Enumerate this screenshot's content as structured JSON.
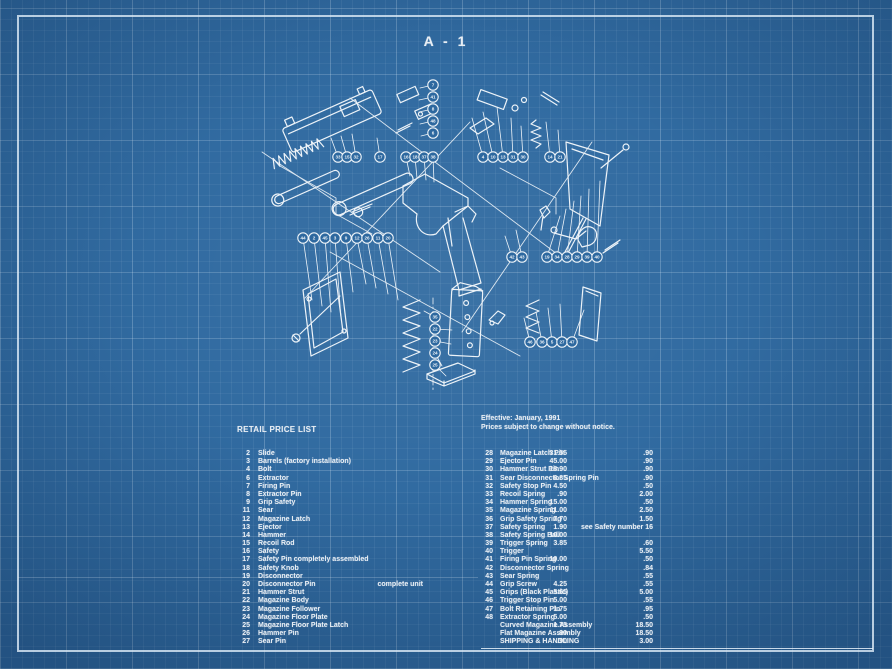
{
  "title": "A - 1",
  "left_list": {
    "header": "RETAIL PRICE LIST",
    "rows": [
      {
        "num": "2",
        "name": "Slide",
        "price": "31.55"
      },
      {
        "num": "3",
        "name": "Barrels (factory installation)",
        "price": "45.00"
      },
      {
        "num": "4",
        "name": "Bolt",
        "price": "18.90"
      },
      {
        "num": "6",
        "name": "Extractor",
        "price": "6.85"
      },
      {
        "num": "7",
        "name": "Firing Pin",
        "price": "4.50"
      },
      {
        "num": "8",
        "name": "Extractor Pin",
        "price": ".90"
      },
      {
        "num": "9",
        "name": "Grip Safety",
        "price": "15.00"
      },
      {
        "num": "11",
        "name": "Sear",
        "price": "11.00"
      },
      {
        "num": "12",
        "name": "Magazine Latch",
        "price": "7.70"
      },
      {
        "num": "13",
        "name": "Ejector",
        "price": "1.90"
      },
      {
        "num": "14",
        "name": "Hammer",
        "price": "10.00"
      },
      {
        "num": "15",
        "name": "Recoil Rod",
        "price": "3.85"
      },
      {
        "num": "16",
        "name": "Safety",
        "price": ""
      },
      {
        "num": "17",
        "name": "Safety Pin completely assembled",
        "price": "10.00"
      },
      {
        "num": "18",
        "name": "Safety Knob",
        "price": ""
      },
      {
        "num": "19",
        "name": "Disconnector",
        "price": ""
      },
      {
        "num": "20",
        "name": "Disconnector Pin",
        "note": "complete unit",
        "price": "4.25"
      },
      {
        "num": "21",
        "name": "Hammer Strut",
        "price": "5.65"
      },
      {
        "num": "22",
        "name": "Magazine Body",
        "price": "5.00"
      },
      {
        "num": "23",
        "name": "Magazine Follower",
        "price": "1.75"
      },
      {
        "num": "24",
        "name": "Magazine Floor Plate",
        "price": "5.00"
      },
      {
        "num": "25",
        "name": "Magazine Floor Plate Latch",
        "price": "1.75"
      },
      {
        "num": "26",
        "name": "Hammer Pin",
        "price": ".90"
      },
      {
        "num": "27",
        "name": "Sear Pin",
        "price": ".90"
      }
    ]
  },
  "right_list": {
    "effective_line1": "Effective: January, 1991",
    "effective_line2": "Prices subject to change without notice.",
    "rows": [
      {
        "num": "28",
        "name": "Magazine Latch Pin",
        "price": ".90"
      },
      {
        "num": "29",
        "name": "Ejector Pin",
        "price": ".90"
      },
      {
        "num": "30",
        "name": "Hammer Strut Pin",
        "price": ".90"
      },
      {
        "num": "31",
        "name": "Sear Disconnector Spring Pin",
        "price": ".90"
      },
      {
        "num": "32",
        "name": "Safety Stop Pin",
        "price": ".50"
      },
      {
        "num": "33",
        "name": "Recoil Spring",
        "price": "2.00"
      },
      {
        "num": "34",
        "name": "Hammer Spring",
        "price": ".50"
      },
      {
        "num": "35",
        "name": "Magazine Spring",
        "price": "2.50"
      },
      {
        "num": "36",
        "name": "Grip Safety Spring",
        "price": "1.50"
      },
      {
        "num": "37",
        "name": "Safety Spring",
        "note": "see Safety number 16",
        "price": ""
      },
      {
        "num": "38",
        "name": "Safety Spring Ball",
        "price": ""
      },
      {
        "num": "39",
        "name": "Trigger Spring",
        "price": ".60"
      },
      {
        "num": "40",
        "name": "Trigger",
        "price": "5.50"
      },
      {
        "num": "41",
        "name": "Firing Pin Spring",
        "price": ".50"
      },
      {
        "num": "42",
        "name": "Disconnector Spring",
        "price": ".84"
      },
      {
        "num": "43",
        "name": "Sear Spring",
        "price": ".55"
      },
      {
        "num": "44",
        "name": "Grip Screw",
        "price": ".55"
      },
      {
        "num": "45",
        "name": "Grips (Black Plastic)",
        "price": "5.00"
      },
      {
        "num": "46",
        "name": "Trigger Stop Pin",
        "price": ".55"
      },
      {
        "num": "47",
        "name": "Bolt Retaining Pin",
        "price": ".95"
      },
      {
        "num": "48",
        "name": "Extractor Spring",
        "price": ".50"
      },
      {
        "num": "",
        "name": "Curved Magazine Assembly",
        "price": "18.50"
      },
      {
        "num": "",
        "name": "Flat Magazine Assembly",
        "price": "18.50"
      },
      {
        "num": "",
        "name": "SHIPPING & HANDLING",
        "price": "3.00"
      }
    ]
  },
  "diagram": {
    "balloons": [
      [
        338,
        157,
        "33",
        331,
        138
      ],
      [
        347,
        157,
        "15",
        341,
        136
      ],
      [
        356,
        157,
        "32",
        352,
        134
      ],
      [
        380,
        157,
        "17",
        377,
        138
      ],
      [
        406,
        157,
        "16",
        410,
        176
      ],
      [
        415,
        157,
        "18",
        417,
        178
      ],
      [
        424,
        157,
        "37",
        426,
        180
      ],
      [
        433,
        157,
        "38",
        434,
        182
      ],
      [
        483,
        157,
        "4",
        472,
        118
      ],
      [
        493,
        157,
        "10",
        483,
        112
      ],
      [
        503,
        157,
        "13",
        497,
        107
      ],
      [
        513,
        157,
        "31",
        511,
        118
      ],
      [
        523,
        157,
        "30",
        521,
        126
      ],
      [
        550,
        157,
        "14",
        546,
        122
      ],
      [
        560,
        157,
        "21",
        558,
        130
      ],
      [
        433,
        85,
        "7",
        420,
        88
      ],
      [
        433,
        97,
        "41",
        419,
        100
      ],
      [
        433,
        109,
        "8",
        419,
        112
      ],
      [
        433,
        121,
        "48",
        420,
        124
      ],
      [
        433,
        133,
        "6",
        421,
        136
      ],
      [
        303,
        238,
        "44",
        312,
        300
      ],
      [
        314,
        238,
        "2",
        322,
        306
      ],
      [
        325,
        238,
        "45",
        331,
        312
      ],
      [
        335,
        238,
        "3",
        341,
        318
      ],
      [
        346,
        238,
        "9",
        353,
        292
      ],
      [
        357,
        238,
        "12",
        366,
        284
      ],
      [
        367,
        238,
        "26",
        376,
        288
      ],
      [
        378,
        238,
        "11",
        388,
        294
      ],
      [
        388,
        238,
        "20",
        398,
        300
      ],
      [
        512,
        257,
        "42",
        505,
        236
      ],
      [
        522,
        257,
        "43",
        516,
        230
      ],
      [
        547,
        257,
        "19",
        560,
        216
      ],
      [
        557,
        257,
        "34",
        566,
        209
      ],
      [
        567,
        257,
        "28",
        574,
        201
      ],
      [
        577,
        257,
        "29",
        581,
        196
      ],
      [
        587,
        257,
        "39",
        589,
        189
      ],
      [
        597,
        257,
        "40",
        600,
        181
      ],
      [
        435,
        317,
        "35",
        424,
        311
      ],
      [
        435,
        329,
        "22",
        452,
        330
      ],
      [
        435,
        341,
        "23",
        451,
        344
      ],
      [
        435,
        353,
        "24",
        442,
        366
      ],
      [
        435,
        365,
        "25",
        446,
        376
      ],
      [
        530,
        342,
        "46",
        524,
        318
      ],
      [
        542,
        342,
        "36",
        536,
        312
      ],
      [
        552,
        342,
        "5",
        548,
        308
      ],
      [
        562,
        342,
        "27",
        560,
        304
      ],
      [
        572,
        342,
        "47",
        584,
        310
      ]
    ]
  },
  "colors": {
    "background": "#2d689f",
    "line": "#edf3f8",
    "text": "#e8eef4",
    "border": "#dfecf7"
  }
}
